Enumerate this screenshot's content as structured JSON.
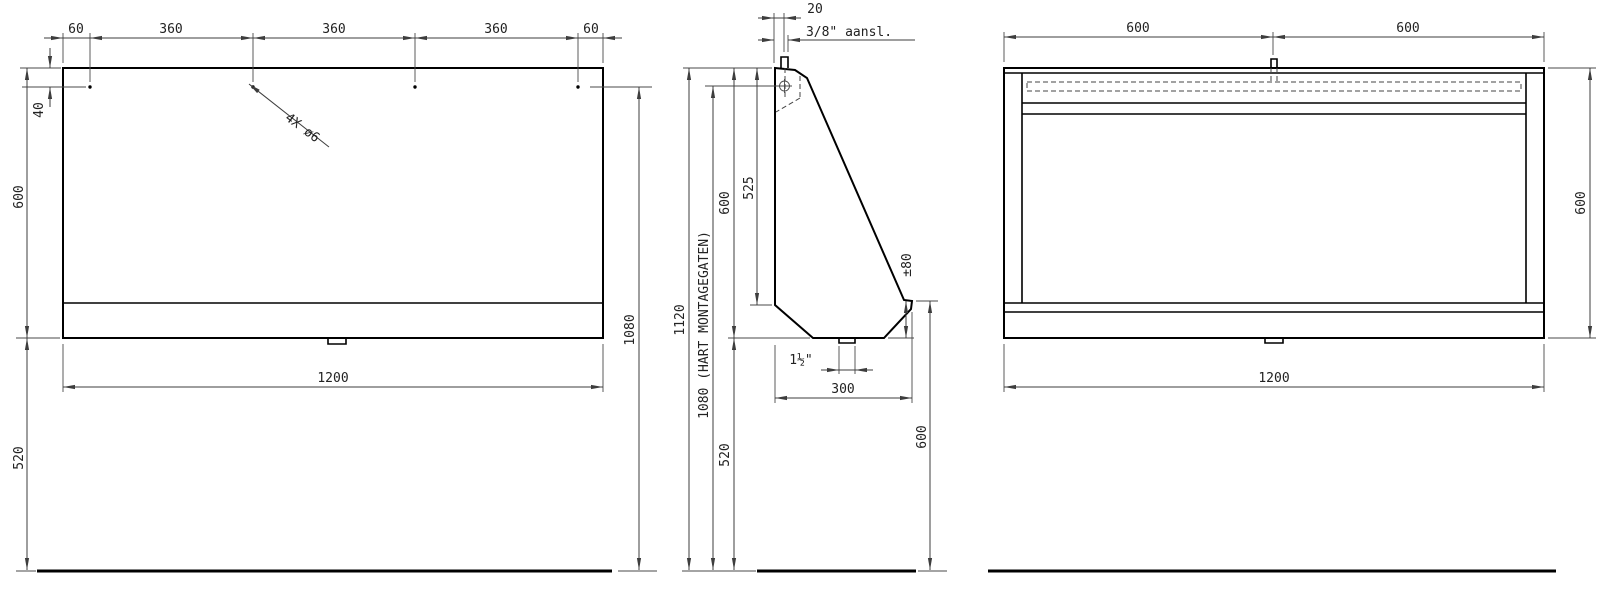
{
  "drawing": {
    "front_view": {
      "top_dims": [
        "60",
        "360",
        "360",
        "360",
        "60"
      ],
      "hole_offset": "40",
      "height": "600",
      "floor_clearance": "520",
      "mount_height": "1080",
      "width": "1200",
      "holes_label": "4X ø6"
    },
    "side_view": {
      "pipe_offset": "20",
      "connection_label": "3/8\" aansl.",
      "total_height": "1120",
      "mount_label": "1080 (HART MONTAGEGATEN)",
      "height": "600",
      "back_depth": "525",
      "floor_clearance": "520",
      "lip_height": "±80",
      "front_height": "600",
      "drain_label": "1½\"",
      "depth": "300"
    },
    "back_view": {
      "top_dims": [
        "600",
        "600"
      ],
      "height": "600",
      "width": "1200"
    }
  }
}
